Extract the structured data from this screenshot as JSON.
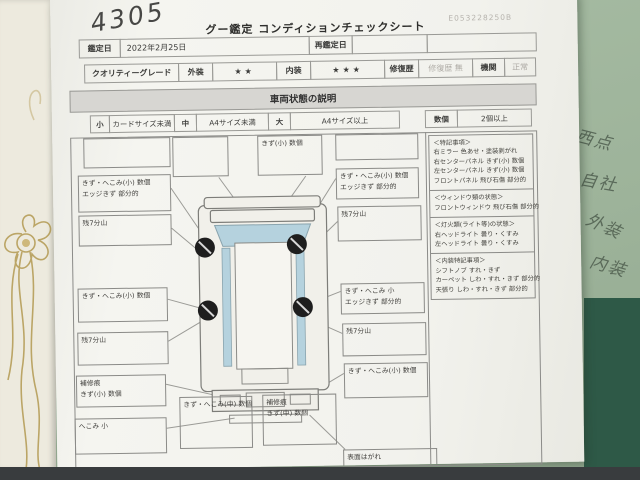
{
  "photo": {
    "handwritten_number": "4305",
    "desk_notes": [
      "西点",
      "自社",
      "外装",
      "内装"
    ]
  },
  "header": {
    "title": "グー鑑定 コンディションチェックシート",
    "serial": "E053228250B"
  },
  "info_row": {
    "date_label": "鑑定日",
    "date_value": "2022年2月25日",
    "redate_label": "再鑑定日",
    "redate_value": ""
  },
  "grade_row": {
    "grade_label": "クオリティーグレード",
    "exterior_label": "外装",
    "exterior_value": "★★",
    "interior_label": "内装",
    "interior_value": "★★★",
    "repair_label": "修復歴",
    "repair_value": "修復歴 無",
    "engine_label": "機関",
    "engine_value": "正常"
  },
  "condition_section": {
    "title": "車両状態の説明",
    "legend": {
      "small_label": "小",
      "small_desc": "カードサイズ未満",
      "medium_label": "中",
      "medium_desc": "A4サイズ未満",
      "large_label": "大",
      "large_desc": "A4サイズ以上",
      "count_label": "数個",
      "count_desc": "2個以上"
    },
    "callouts": {
      "left": [
        {
          "line1": "",
          "line2": ""
        },
        {
          "line1": "きず・へこみ(小) 数個",
          "line2": "エッジきず 部分的"
        },
        {
          "line1": "残7分山",
          "line2": ""
        },
        {
          "line1": "きず・へこみ(小) 数個",
          "line2": ""
        },
        {
          "line1": "残7分山",
          "line2": ""
        },
        {
          "line1": "補修痕",
          "line2": "きず(小) 数個"
        },
        {
          "line1": "へこみ 小",
          "line2": ""
        }
      ],
      "top": [
        {
          "line1": "",
          "line2": ""
        },
        {
          "line1": "きず(小) 数個",
          "line2": ""
        }
      ],
      "bottom": [
        {
          "line1": "きず・へこみ(中) 数個",
          "line2": ""
        },
        {
          "line1": "補修痕",
          "line2": "きず(中) 数個"
        }
      ],
      "right": [
        {
          "line1": "",
          "line2": ""
        },
        {
          "line1": "きず・へこみ(小) 数個",
          "line2": "エッジきず 部分的"
        },
        {
          "line1": "残7分山",
          "line2": ""
        },
        {
          "line1": "きず・へこみ 小",
          "line2": "エッジきず 部分的"
        },
        {
          "line1": "残7分山",
          "line2": ""
        },
        {
          "line1": "きず・へこみ(小) 数個",
          "line2": ""
        },
        {
          "line1": "表面はがれ",
          "line2": ""
        }
      ]
    },
    "notes": {
      "sections": [
        {
          "heading": "＜特記事項＞",
          "lines": [
            "右ミラー 色あせ・塗装剥がれ",
            "右センターパネル きず(小) 数個",
            "左センターパネル きず(小) 数個",
            "フロントパネル 飛び石傷 部分的"
          ]
        },
        {
          "heading": "＜ウィンドウ類の状態＞",
          "lines": [
            "フロントウィンドウ 飛び石傷 部分的"
          ]
        },
        {
          "heading": "＜灯火類(ライト等)の状態＞",
          "lines": [
            "右ヘッドライト 曇り・くすみ",
            "左ヘッドライト 曇り・くすみ"
          ]
        },
        {
          "heading": "＜内装特記事項＞",
          "lines": [
            "シフトノブ すれ・きず",
            "カーペット しわ・すれ・きず 部分的",
            "天張り しわ・すれ・きず 部分的"
          ]
        }
      ]
    }
  },
  "colors": {
    "desk_light": "#a3b8a0",
    "desk_dark": "#2e5947",
    "paper": "#f3f3ee",
    "section_bar": "#d7d6d2",
    "window_blue": "#b5d2de",
    "gold_decor": "#b39a52",
    "bottom_strip": "#393c3e"
  }
}
